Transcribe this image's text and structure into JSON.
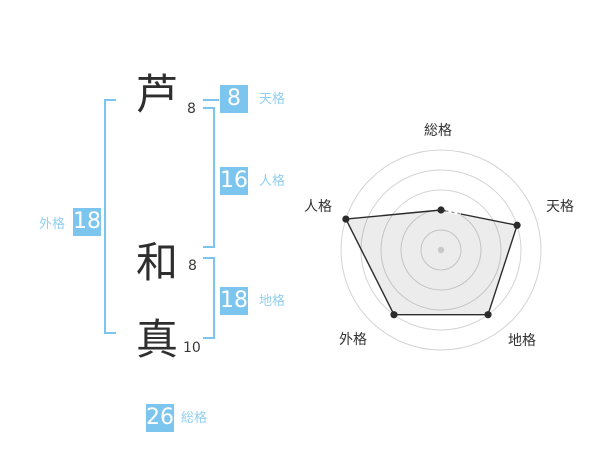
{
  "colors": {
    "accent_blue": "#7cc5ee",
    "label_blue": "#92cff0",
    "text_dark": "#2e2e2e",
    "ring_gray": "#d4d4d4",
    "polygon_stroke": "#2b2b2b",
    "polygon_fill": "rgba(0,0,0,0.075)",
    "center_dot_gray": "#c9c9c9",
    "dash_gray": "#999999"
  },
  "name": {
    "characters": [
      {
        "char": "芦",
        "strokes": "8"
      },
      {
        "char": "和",
        "strokes": "8"
      },
      {
        "char": "真",
        "strokes": "10"
      }
    ]
  },
  "gokaku": {
    "tenkaku": {
      "label": "天格",
      "value": "8"
    },
    "jinkaku": {
      "label": "人格",
      "value": "16"
    },
    "chikaku": {
      "label": "地格",
      "value": "18"
    },
    "gaikaku": {
      "label": "外格",
      "value": "18"
    },
    "soukaku": {
      "label": "総格",
      "value": "26"
    }
  },
  "chart_data": {
    "type": "radar",
    "categories": [
      "総格",
      "天格",
      "地格",
      "外格",
      "人格"
    ],
    "values": [
      2,
      4,
      4,
      4,
      5
    ],
    "max": 5,
    "rings": 5,
    "first_axis": "top",
    "direction": "clockwise",
    "scores": {
      "総格": 26,
      "天格": 8,
      "地格": 18,
      "外格": 18,
      "人格": 16
    },
    "legend": "none",
    "grid": "circular"
  }
}
